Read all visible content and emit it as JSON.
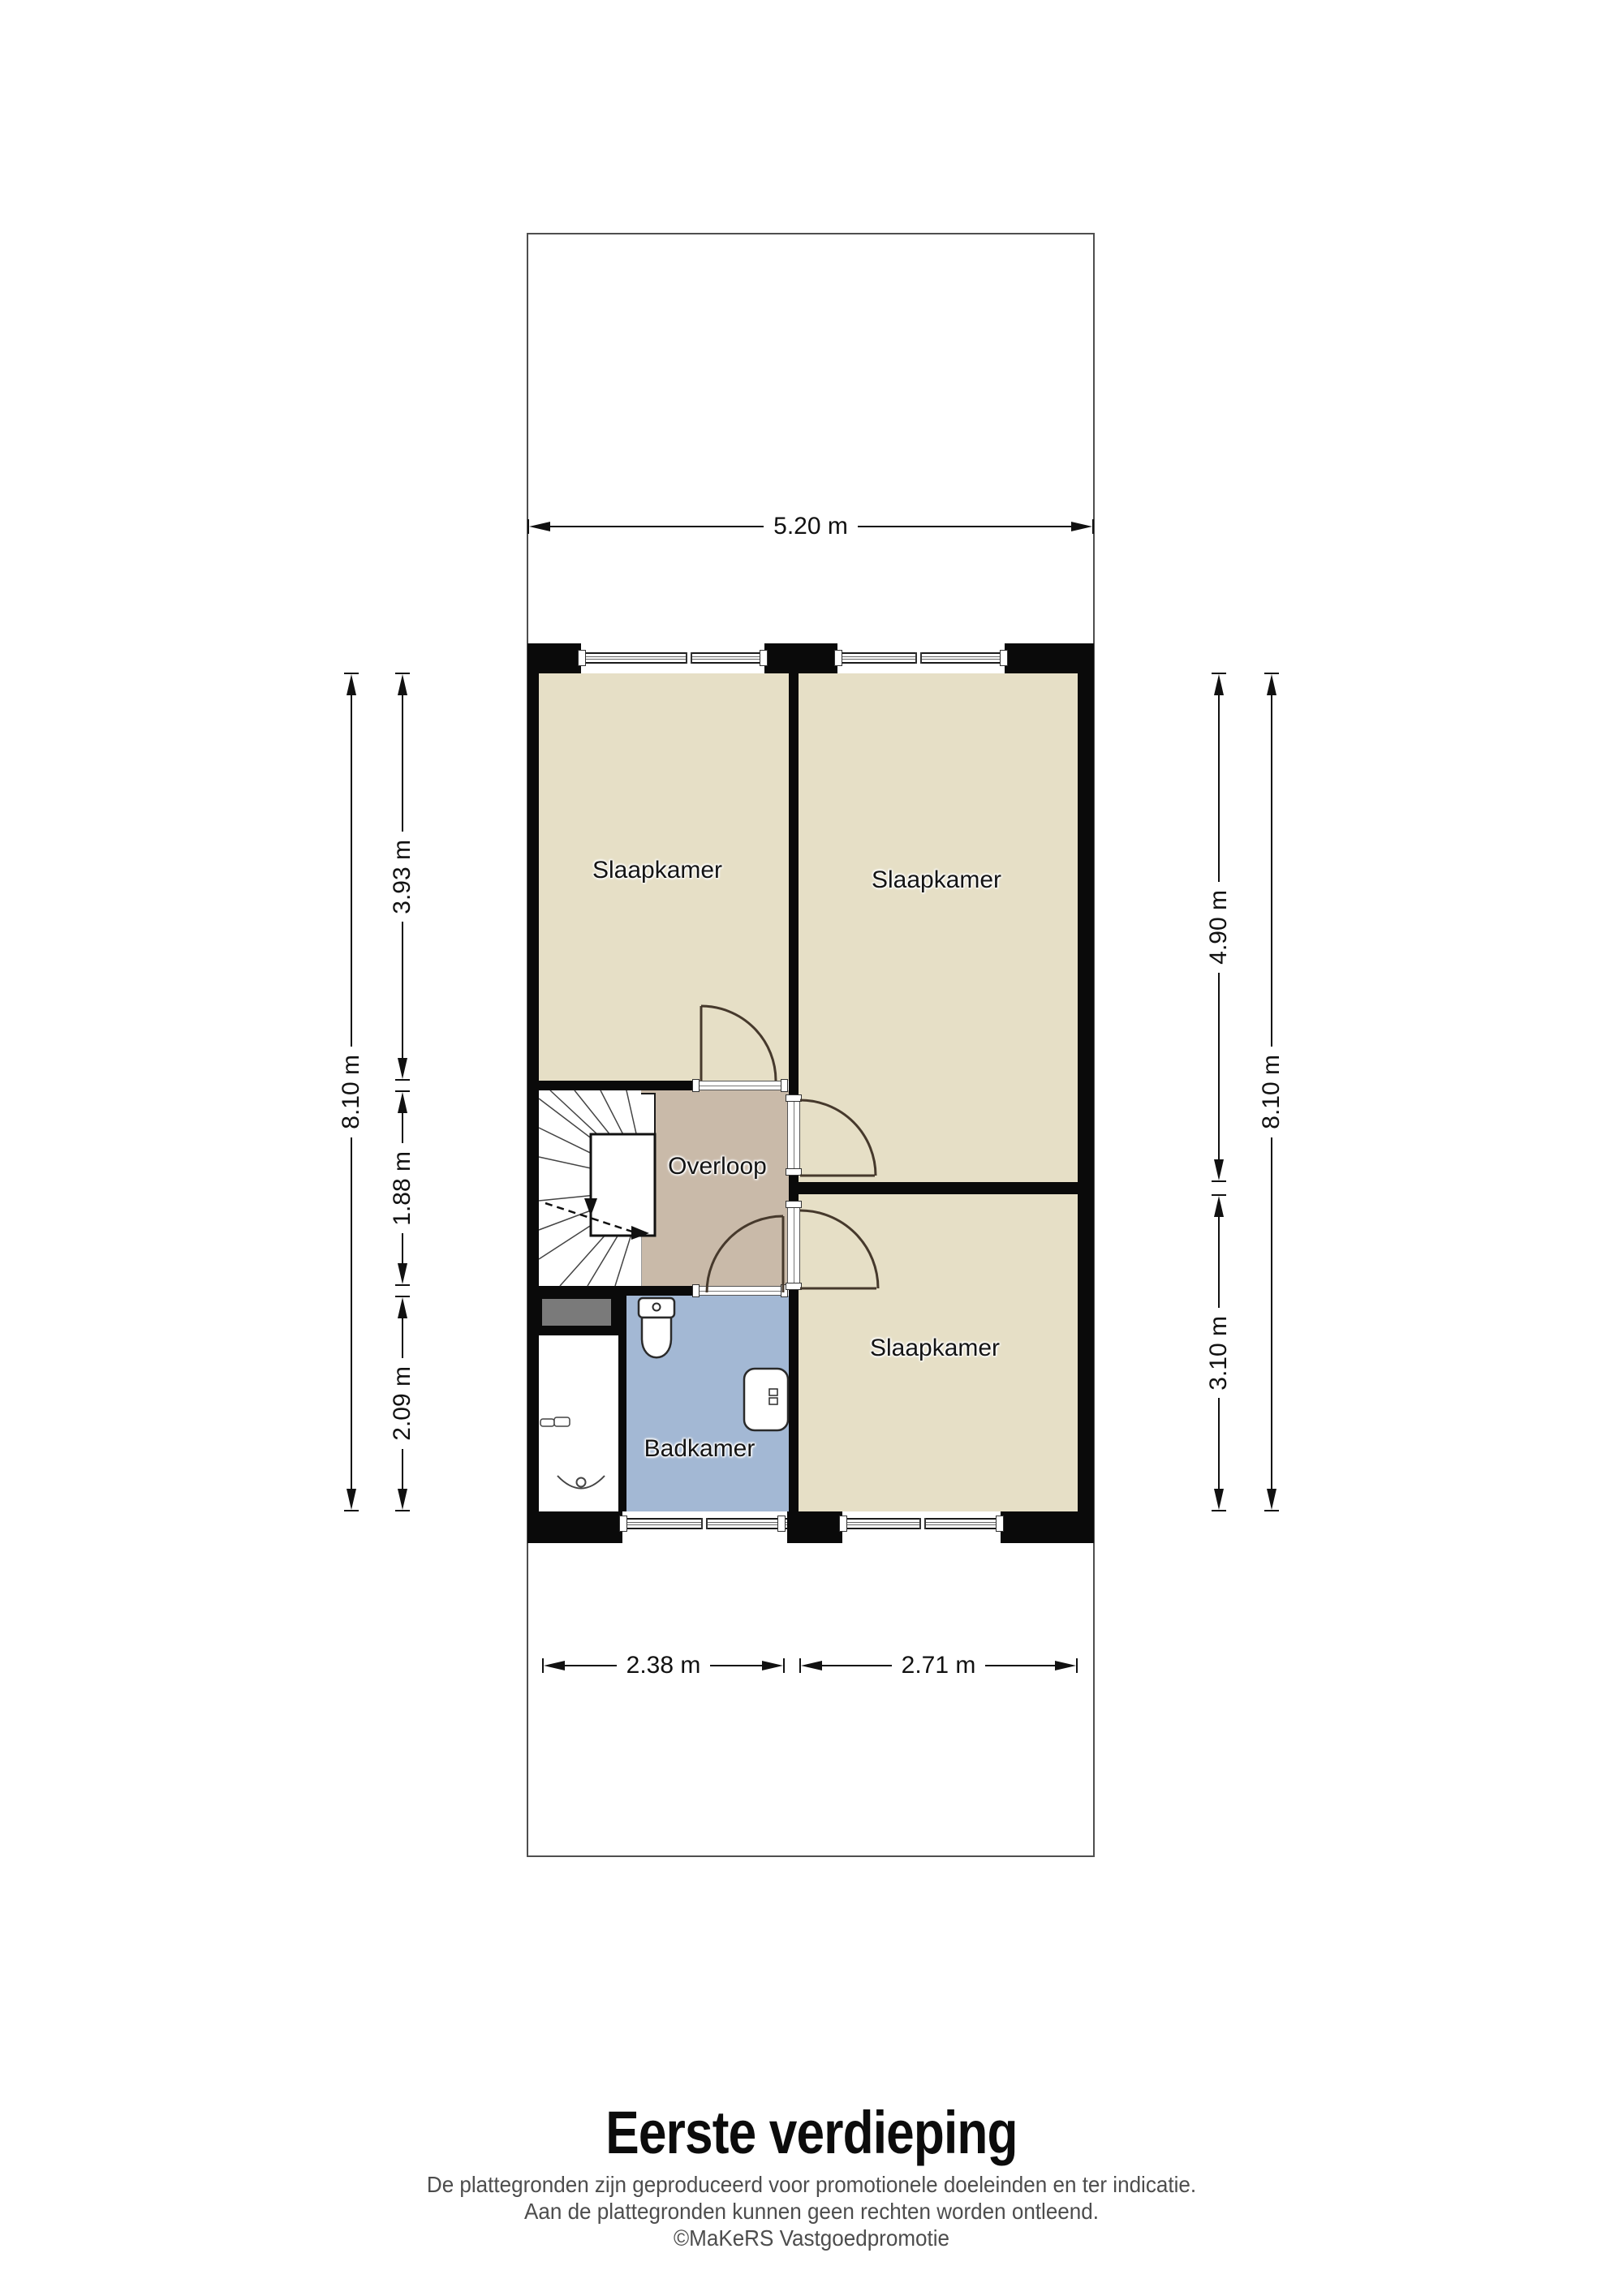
{
  "floorplan": {
    "title": "Eerste verdieping",
    "footer": {
      "disclaimer_line1": "De plattegronden zijn geproduceerd voor promotionele doeleinden en ter indicatie.",
      "disclaimer_line2": "Aan de plattegronden kunnen geen rechten worden ontleend.",
      "credit": "©MaKeRS Vastgoedpromotie"
    },
    "rooms": [
      {
        "id": "slaapkamer-top-left",
        "label": "Slaapkamer"
      },
      {
        "id": "slaapkamer-top-right",
        "label": "Slaapkamer"
      },
      {
        "id": "slaapkamer-bottom-right",
        "label": "Slaapkamer"
      },
      {
        "id": "overloop",
        "label": "Overloop"
      },
      {
        "id": "badkamer",
        "label": "Badkamer"
      }
    ],
    "dimensions": {
      "top_width": "5.20 m",
      "left_total": "8.10 m",
      "left_top": "3.93 m",
      "left_middle": "1.88 m",
      "left_bottom": "2.09 m",
      "right_top": "4.90 m",
      "right_bottom": "3.10 m",
      "right_total": "8.10 m",
      "bottom_left": "2.38 m",
      "bottom_right": "2.71 m"
    },
    "colors": {
      "room_beige": "#e6dfc6",
      "hall_taupe": "#c9baa9",
      "bath_blue": "#a3b8d4",
      "stair_gray": "#7a7a7a",
      "wall_black": "#0a0a0a"
    }
  }
}
